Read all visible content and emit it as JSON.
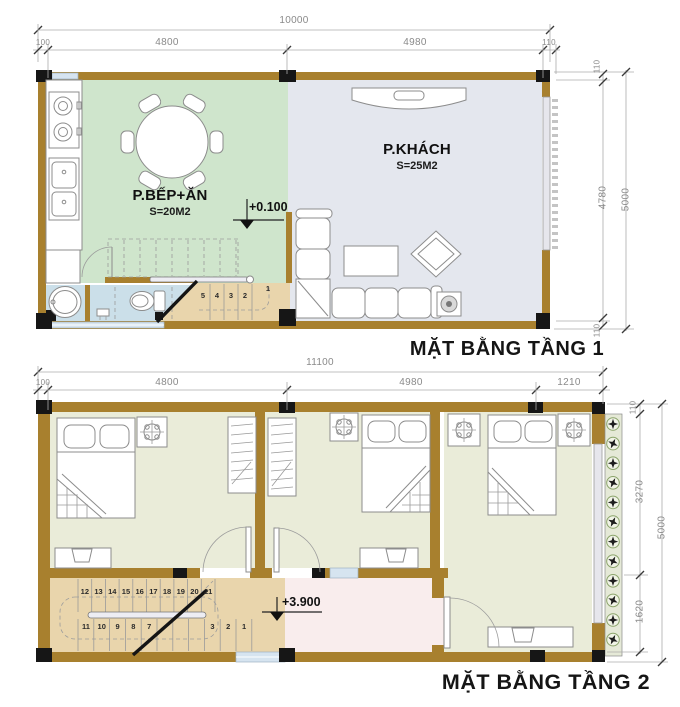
{
  "palette": {
    "wall": "#a8802e",
    "column": "#161616",
    "kitchen": "#cfe5cc",
    "living": "#e4e7ee",
    "bathroom": "#cbdfe9",
    "stair": "#e9d5ac",
    "bedroom": "#eaecd9",
    "hallway": "#f9eded",
    "balcony": "#e5e9d7",
    "window": "#d6e4f0",
    "dim_text": "#8a8a8a"
  },
  "floor1": {
    "title": "MẶT BẰNG TẦNG 1",
    "kitchen_name": "P.BẾP+ĂN",
    "kitchen_area": "S=20M2",
    "living_name": "P.KHÁCH",
    "living_area": "S=25M2",
    "level_mark": "+0.100",
    "stairs_flight": [
      "5",
      "4",
      "3",
      "2"
    ],
    "stairs_landing": "1",
    "dim_top_total": "10000",
    "dim_left_wall": "100",
    "dim_kitchen": "4800",
    "dim_living": "4980",
    "dim_right_wall": "110",
    "dim_right_small_top": "110",
    "dim_right_inner": "4780",
    "dim_right_small_bottom": "110",
    "dim_right_total": "5000"
  },
  "floor2": {
    "title": "MẶT BẰNG TẦNG 2",
    "level_mark": "+3.900",
    "stairs_upper": [
      "12",
      "13",
      "14",
      "15",
      "16",
      "17",
      "18",
      "19",
      "20",
      "21"
    ],
    "stairs_lower": [
      "11",
      "10",
      "9",
      "8",
      "7",
      "",
      "",
      "",
      "3",
      "2",
      "1"
    ],
    "dim_top_total": "11100",
    "dim_left_wall": "100",
    "dim_seg1": "4800",
    "dim_seg2": "4980",
    "dim_seg3": "1210",
    "dim_right_small_top": "110",
    "dim_right_seg1": "3270",
    "dim_right_seg2": "1620",
    "dim_right_total": "5000"
  }
}
